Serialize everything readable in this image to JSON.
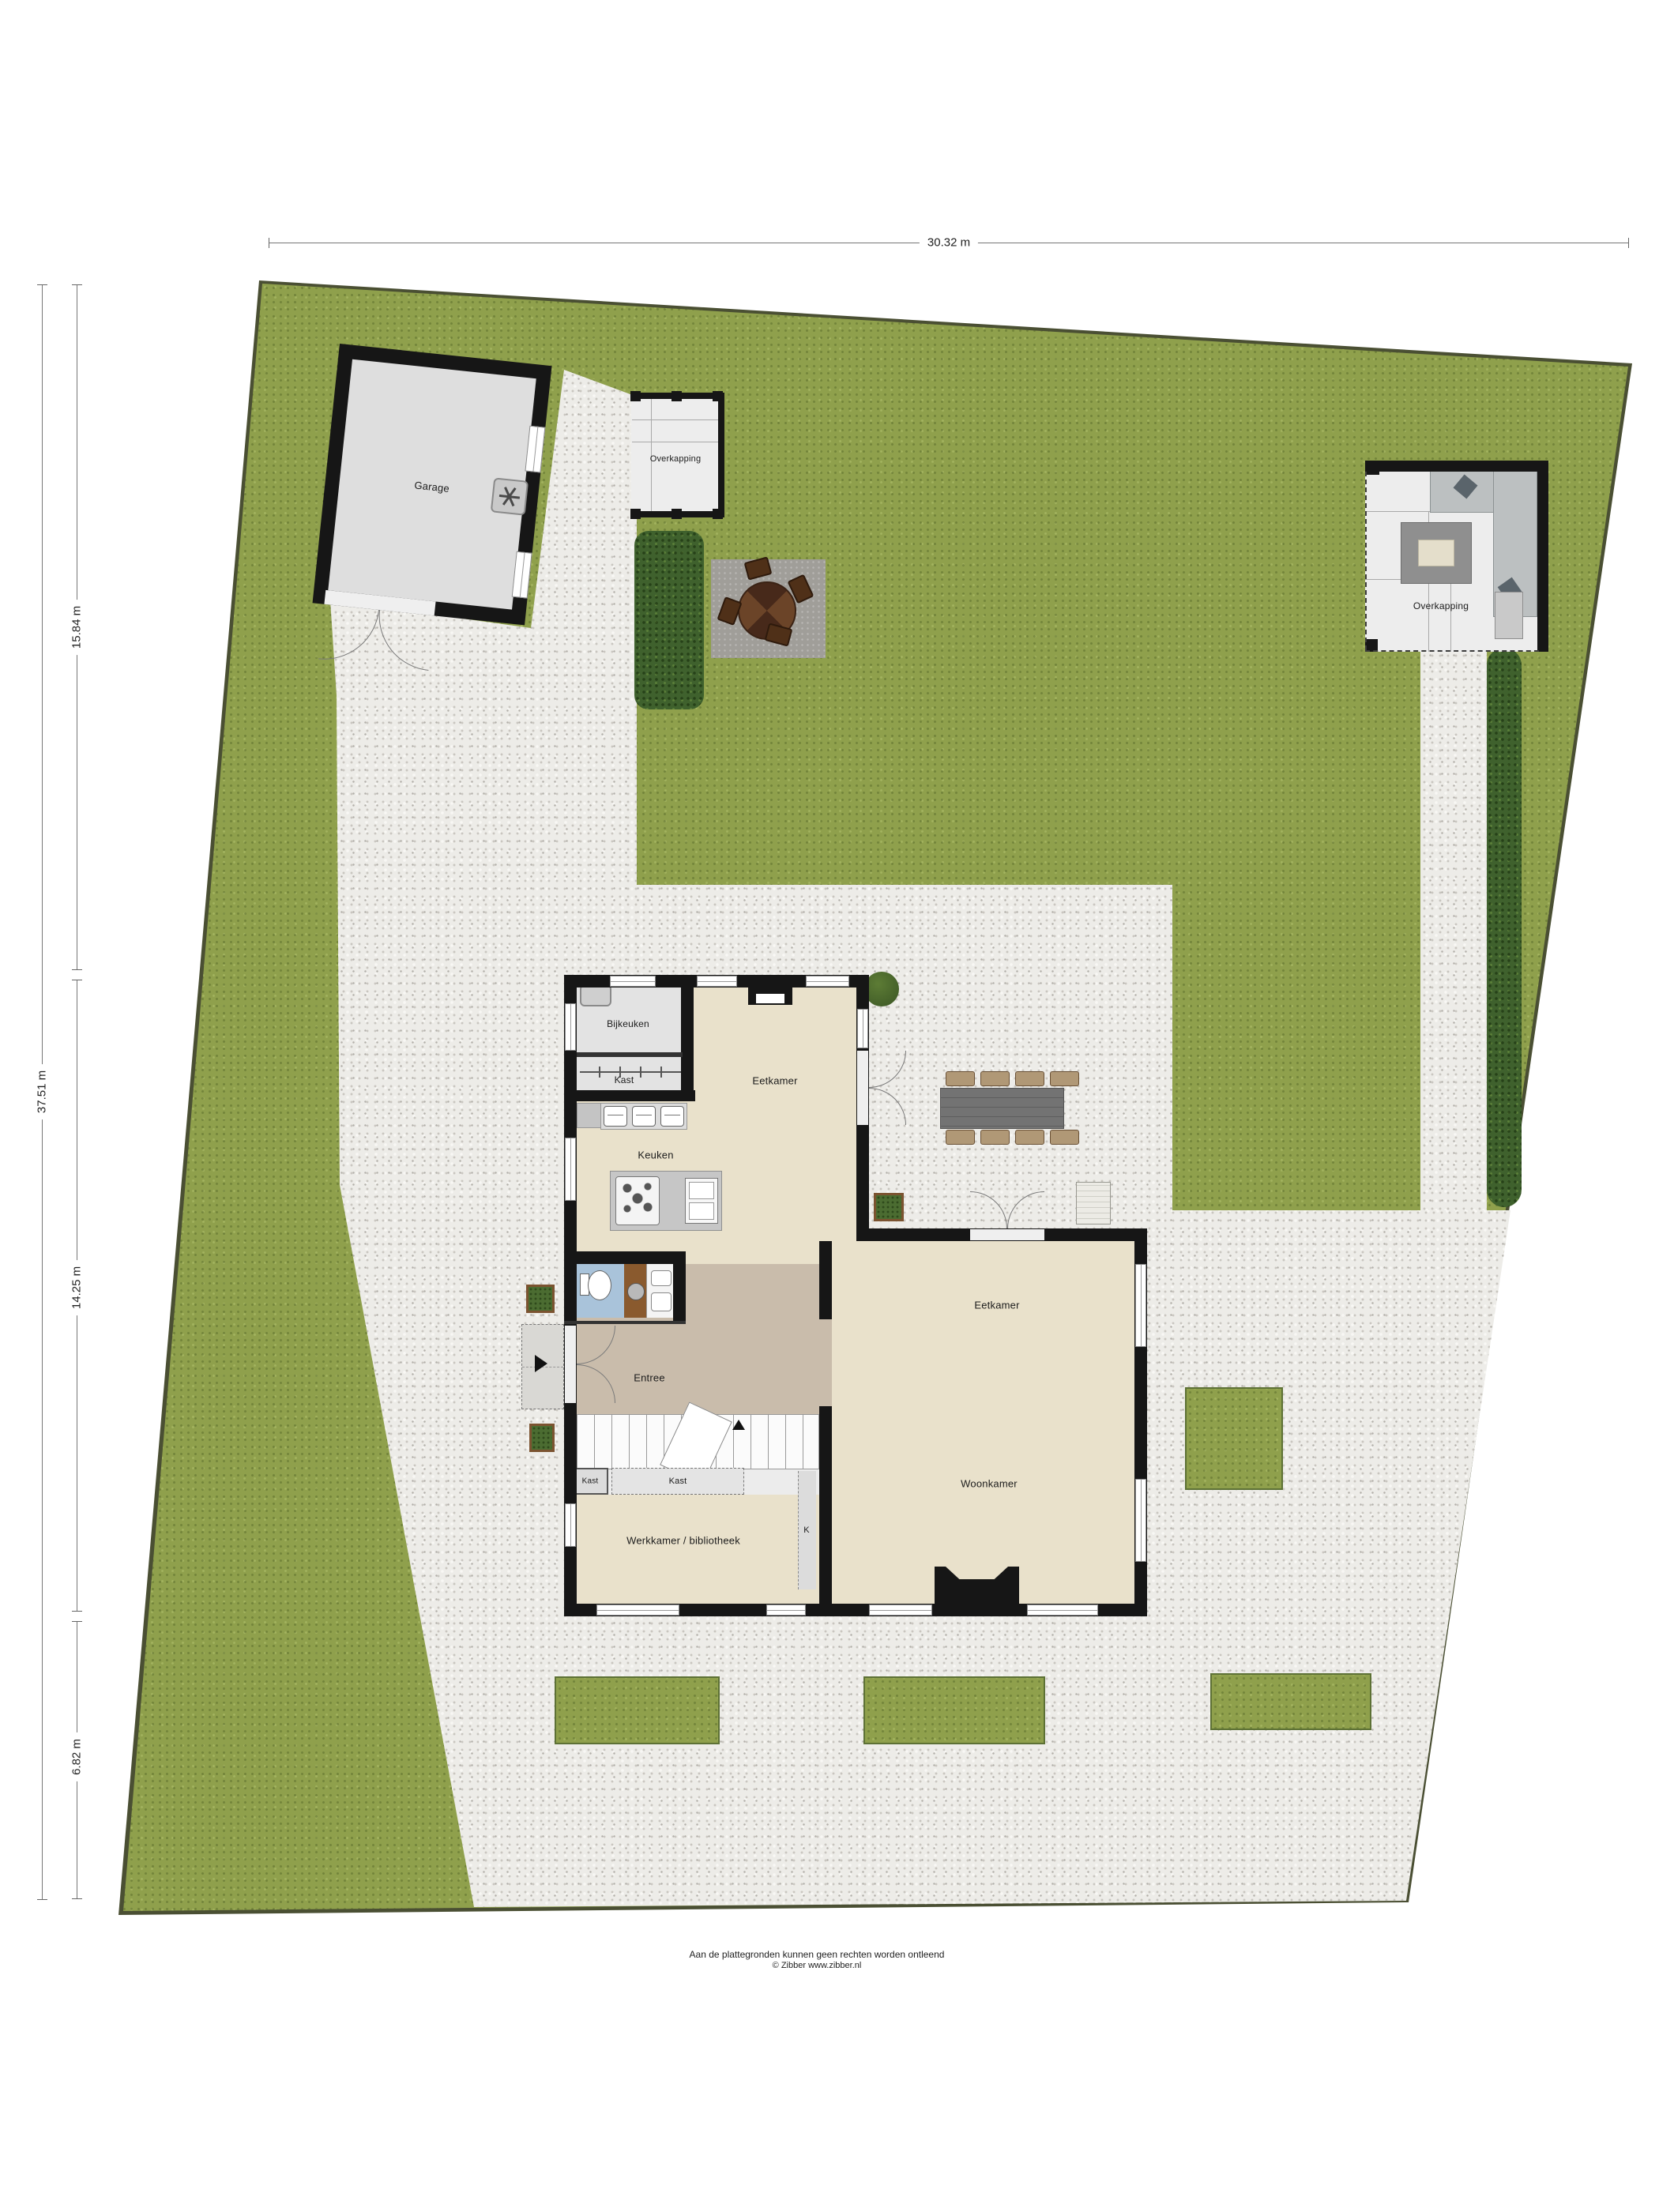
{
  "dimensions": {
    "width_top": "30.32 m",
    "height_total": "37.51 m",
    "height_segment_1": "15.84 m",
    "height_segment_2": "14.25 m",
    "height_segment_3": "6.82 m"
  },
  "outbuildings": {
    "garage": "Garage",
    "overkapping_left": "Overkapping",
    "overkapping_right": "Overkapping"
  },
  "rooms": {
    "bijkeuken": "Bijkeuken",
    "kast_top": "Kast",
    "eetkamer_top": "Eetkamer",
    "keuken": "Keuken",
    "entree": "Entree",
    "kast_small": "Kast",
    "kast_middle": "Kast",
    "kast_k": "K",
    "werkkamer": "Werkkamer / bibliotheek",
    "eetkamer": "Eetkamer",
    "woonkamer": "Woonkamer"
  },
  "footer": {
    "disclaimer": "Aan de plattegronden kunnen geen rechten worden ontleend",
    "credit": "© Zibber www.zibber.nl"
  },
  "colors": {
    "grass": "#8fa04c",
    "gravel": "#edece8",
    "hedge": "#3f612d",
    "wall": "#161616",
    "floor_beige": "#e9e1cb",
    "floor_gray": "#e3e3e3",
    "floor_entree": "#c9bcab",
    "floor_wc": "#a9c3da",
    "wood": "#8a5a2e",
    "garage_floor": "#dedede",
    "pad": "#a09e99"
  }
}
